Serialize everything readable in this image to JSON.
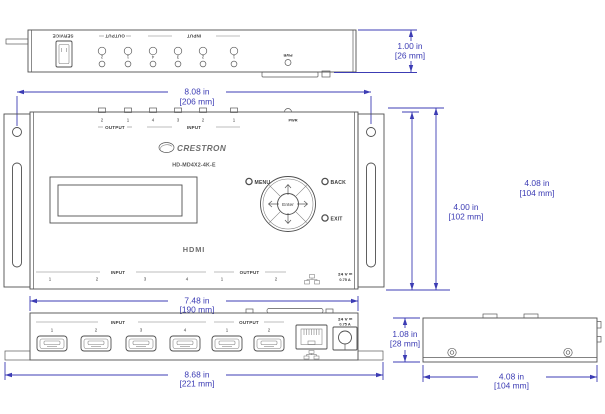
{
  "colors": {
    "dimension_accent": "#3c3cb4",
    "drawing_line": "#4f4f4f",
    "background": "#ffffff"
  },
  "views": {
    "top": {
      "service": "SERVICE",
      "output_label": "OUTPUT",
      "input_label": "INPUT",
      "pwr": "PWR",
      "output_nums": [
        "2",
        "1"
      ],
      "input_nums": [
        "4",
        "3",
        "2",
        "1"
      ]
    },
    "front": {
      "top_output_label": "OUTPUT",
      "top_input_label": "INPUT",
      "pwr": "PWR",
      "top_output_nums": [
        "2",
        "1"
      ],
      "top_input_nums": [
        "4",
        "3",
        "2",
        "1"
      ],
      "brand": "CRESTRON",
      "model": "HD-MD4X2-4K-E",
      "menu": "MENU",
      "back": "BACK",
      "exit": "EXIT",
      "enter": "Enter",
      "hdmi": "HDMI",
      "bottom_input_label": "INPUT",
      "bottom_output_label": "OUTPUT",
      "bottom_input_nums": [
        "1",
        "2",
        "3",
        "4"
      ],
      "bottom_output_nums": [
        "1",
        "2"
      ],
      "volt": "24 V ⎓",
      "amp": "0.75 A"
    },
    "panel": {
      "input_label": "INPUT",
      "output_label": "OUTPUT",
      "input_nums": [
        "1",
        "2",
        "3",
        "4"
      ],
      "output_nums": [
        "1",
        "2"
      ],
      "volt": "24 V ⎓",
      "amp": "0.75 A"
    }
  },
  "dims": {
    "top_height_in": "1.00 in",
    "top_height_mm": "[26 mm]",
    "mount_in": "8.08 in",
    "mount_mm": "[206 mm]",
    "body_in": "4.00 in",
    "body_mm": "[102 mm]",
    "total_h_in": "4.08 in",
    "total_h_mm": "[104 mm]",
    "front_in": "7.48 in",
    "front_mm": "[190 mm]",
    "total_w_in": "8.68 in",
    "total_w_mm": "[221 mm]",
    "side_h_in": "1.08 in",
    "side_h_mm": "[28 mm]",
    "depth_in": "4.08 in",
    "depth_mm": "[104 mm]"
  }
}
